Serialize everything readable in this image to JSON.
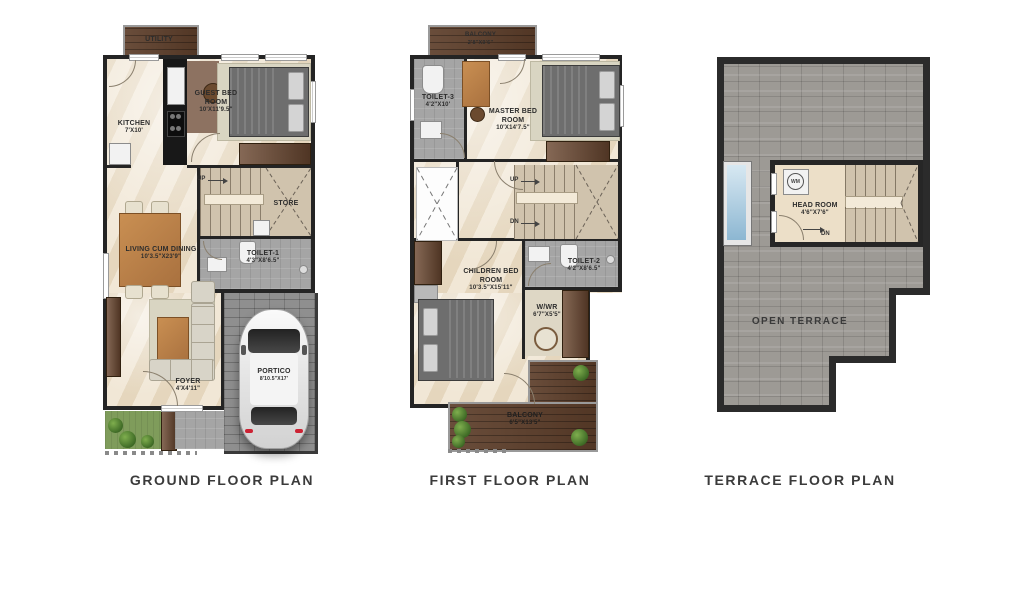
{
  "captions": {
    "ground": "GROUND FLOOR PLAN",
    "first": "FIRST FLOOR PLAN",
    "terrace": "TERRACE FLOOR PLAN"
  },
  "ground": {
    "utility": {
      "name": "UTILITY"
    },
    "kitchen": {
      "name": "KITCHEN",
      "dims": "7'X10'"
    },
    "guest_bed": {
      "name": "GUEST BED ROOM",
      "dims": "10'X11'9.5\""
    },
    "stairs": {
      "up": "UP"
    },
    "store": {
      "name": "STORE"
    },
    "living": {
      "name": "LIVING CUM DINING",
      "dims": "10'3.5\"X23'9\""
    },
    "toilet1": {
      "name": "TOILET-1",
      "dims": "4'3\"X8'6.5\""
    },
    "foyer": {
      "name": "FOYER",
      "dims": "4'X4'11\""
    },
    "portico": {
      "name": "PORTICO",
      "dims": "8'10.5\"X17'"
    }
  },
  "first": {
    "balcony_top": {
      "name": "BALCONY",
      "dims": "2'8\"X9'6\""
    },
    "toilet3": {
      "name": "TOILET-3",
      "dims": "4'2\"X10'"
    },
    "master_bed": {
      "name": "MASTER BED ROOM",
      "dims": "10'X14'7.5\""
    },
    "stairs": {
      "up": "UP",
      "dn": "DN"
    },
    "children_bed": {
      "name": "CHILDREN BED ROOM",
      "dims": "10'3.5\"X15'11\""
    },
    "toilet2": {
      "name": "TOILET-2",
      "dims": "4'2\"X8'6.5\""
    },
    "wwr": {
      "name": "W/WR",
      "dims": "6'7\"X5'5\""
    },
    "balcony_bottom": {
      "name": "BALCONY",
      "dims": "6'5\"X13'5\""
    }
  },
  "terrace": {
    "head_room": {
      "name": "HEAD ROOM",
      "dims": "4'6\"X7'6\""
    },
    "wm": {
      "label": "WM"
    },
    "stairs": {
      "dn": "DN"
    },
    "open_terrace": {
      "name": "OPEN TERRACE"
    }
  },
  "colors": {
    "wall": "#242424",
    "floor_marble": "#ecdfc8",
    "wood_deck": "#5d3e2a",
    "driveway_paver": "#8f8f8f",
    "terrace_paver": "#9d9a95",
    "stairs": "#d0c3ad",
    "toilet_floor": "#a5a5a5",
    "grass": "#7f9c5b",
    "skylight": "#9fc4dc"
  }
}
